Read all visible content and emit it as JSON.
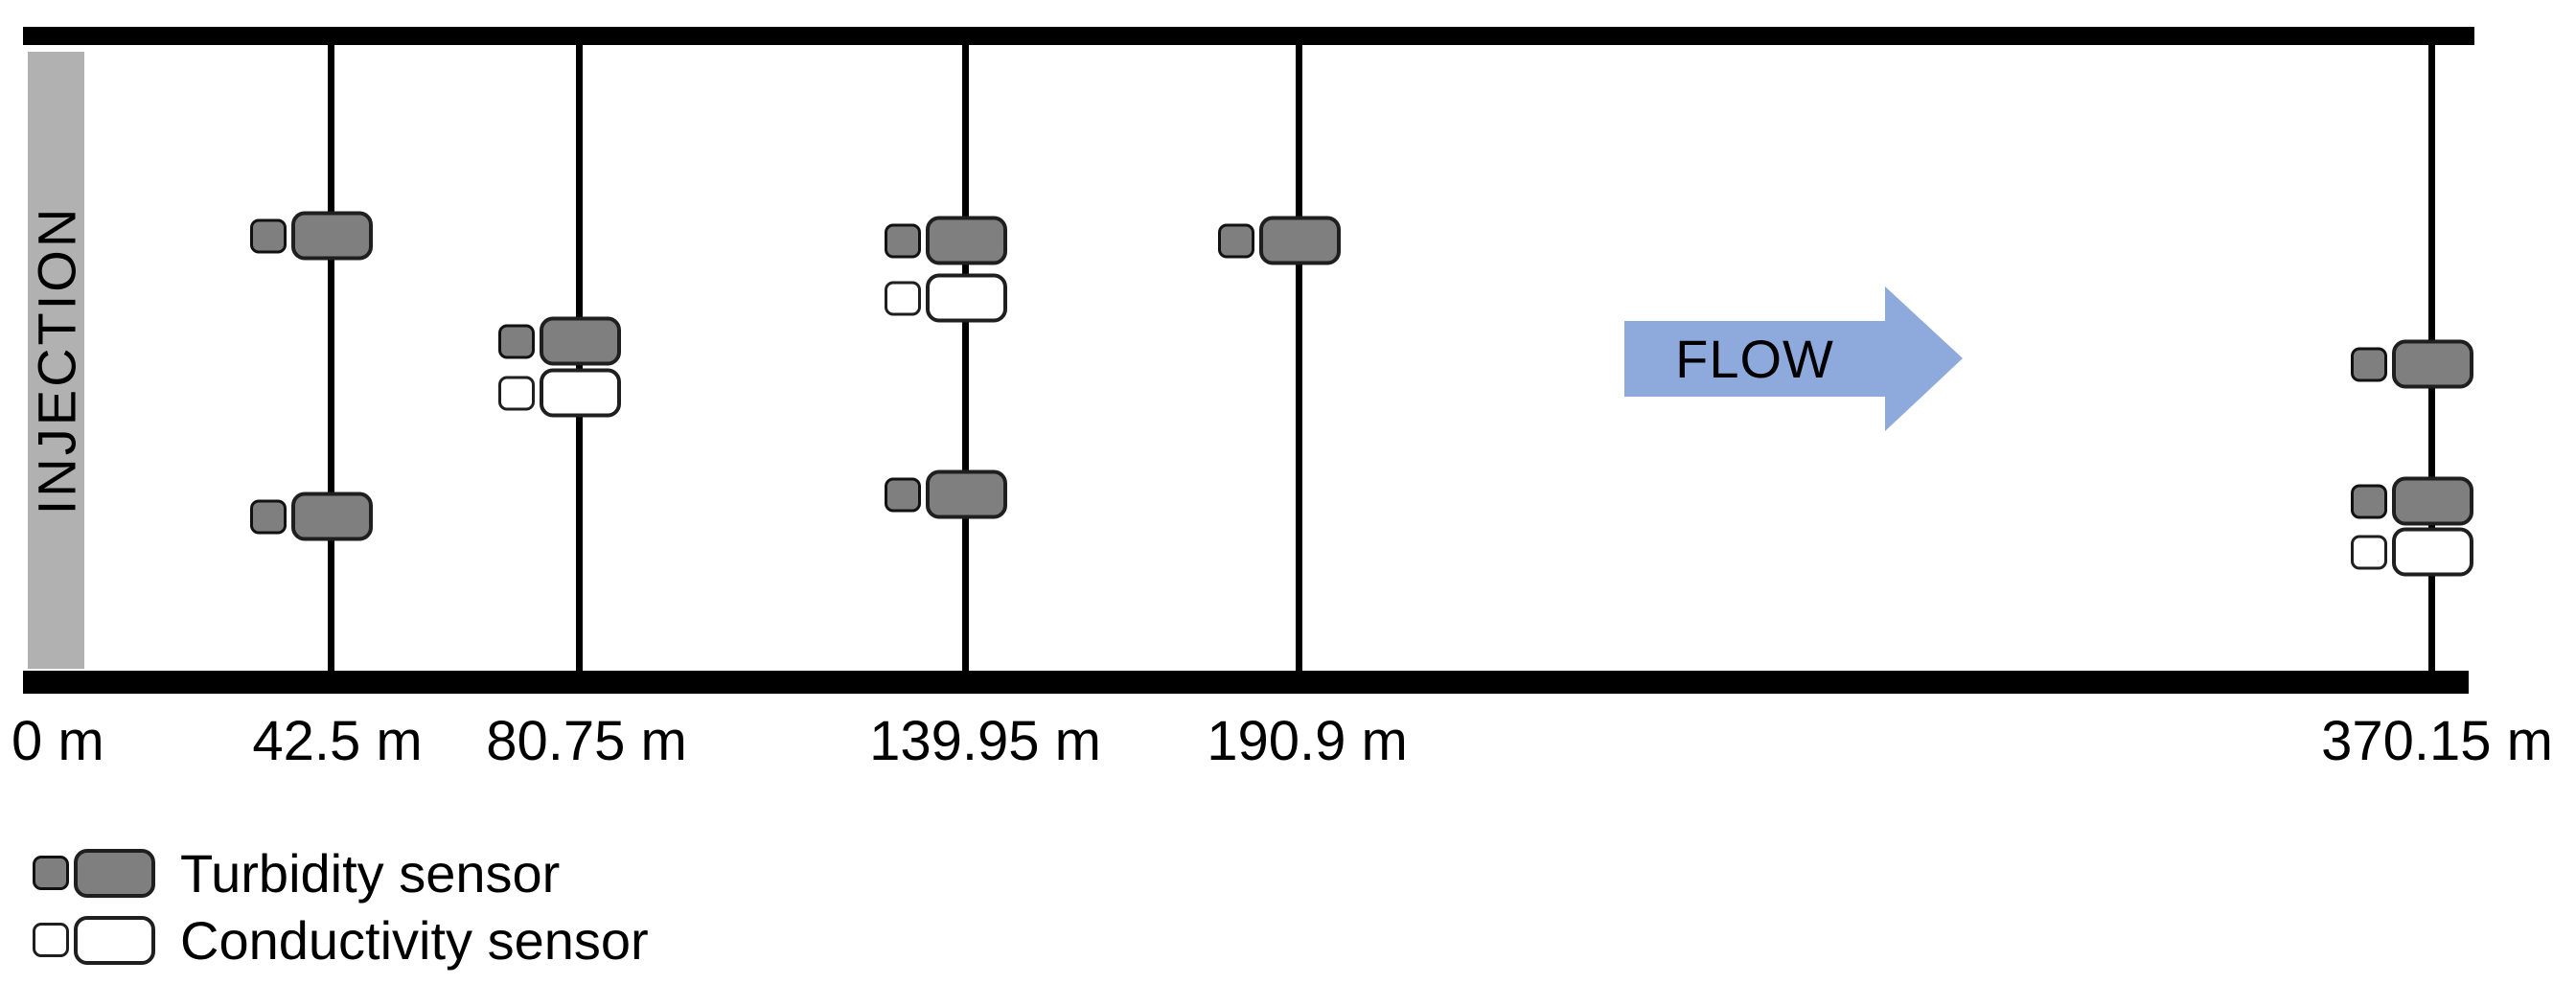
{
  "diagram": {
    "type": "flume sensor layout schematic",
    "injection": {
      "label": "INJECTION"
    },
    "flow": {
      "label": "FLOW"
    },
    "stations": [
      {
        "label": "0 m",
        "distance_m": 0,
        "sensors": []
      },
      {
        "label": "42.5 m",
        "distance_m": 42.5,
        "sensors": [
          "turbidity",
          "turbidity"
        ]
      },
      {
        "label": "80.75 m",
        "distance_m": 80.75,
        "sensors": [
          "turbidity",
          "conductivity"
        ]
      },
      {
        "label": "139.95 m",
        "distance_m": 139.95,
        "sensors": [
          "turbidity",
          "conductivity",
          "turbidity"
        ]
      },
      {
        "label": "190.9 m",
        "distance_m": 190.9,
        "sensors": [
          "turbidity"
        ]
      },
      {
        "label": "370.15 m",
        "distance_m": 370.15,
        "sensors": [
          "turbidity",
          "turbidity",
          "conductivity"
        ]
      }
    ],
    "legend": {
      "items": [
        {
          "type": "turbidity",
          "label": "Turbidity sensor"
        },
        {
          "type": "conductivity",
          "label": "Conductivity sensor"
        }
      ]
    },
    "colors": {
      "turbidity_fill": "#7f7f7f",
      "conductivity_fill": "#ffffff",
      "injection_bar": "#b1b1b1",
      "flow_arrow": "#8ea9db",
      "wall": "#000000"
    }
  }
}
